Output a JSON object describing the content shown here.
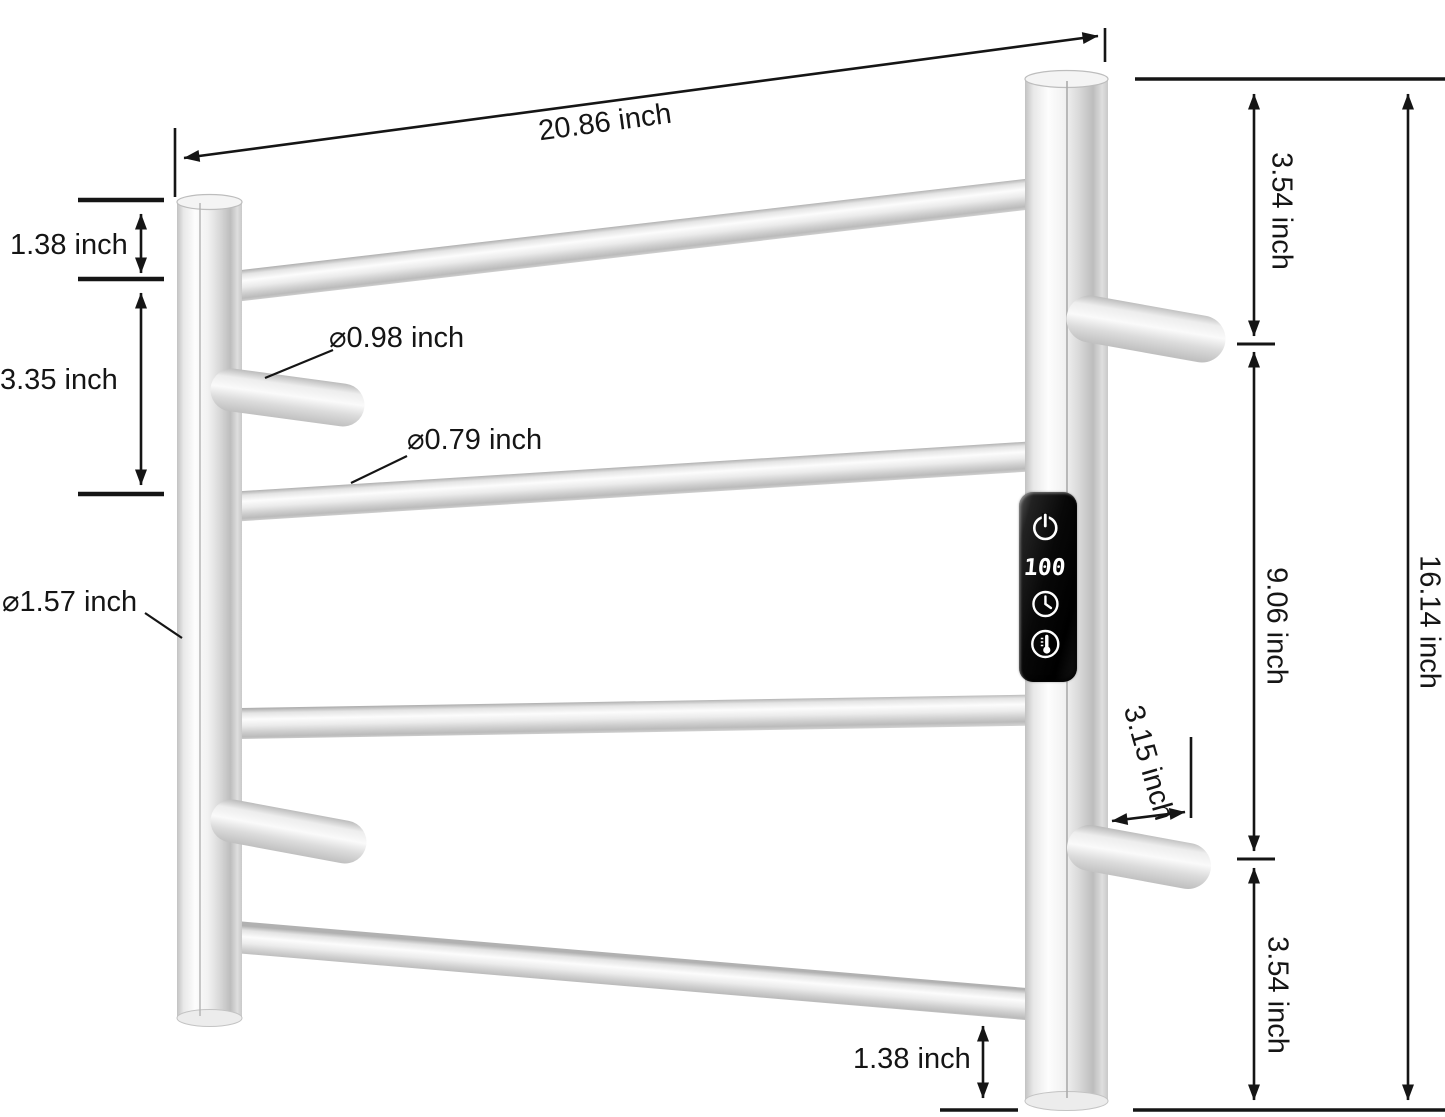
{
  "dimensions": {
    "top_width": "20.86 inch",
    "left_top_gap": "1.38 inch",
    "left_bar_spacing": "3.35 inch",
    "post_diameter": "⌀1.57 inch",
    "hook_diameter": "⌀0.98 inch",
    "bar_diameter": "⌀0.79 inch",
    "right_top_gap": "3.54 inch",
    "right_middle_span": "9.06 inch",
    "right_bottom_gap": "3.54 inch",
    "total_height": "16.14 inch",
    "hook_length": "3.15 inch",
    "bottom_gap": "1.38 inch"
  },
  "control_panel": {
    "display_value": "100",
    "icons": [
      "power-icon",
      "timer-icon",
      "temperature-icon"
    ]
  },
  "colors": {
    "background": "#ffffff",
    "dimension_lines": "#151515",
    "steel_highlight": "#fdfdfd",
    "steel_mid": "#d8d8d8",
    "steel_shadow": "#b4b4b4",
    "panel_background": "#000000",
    "panel_foreground": "#ffffff"
  }
}
